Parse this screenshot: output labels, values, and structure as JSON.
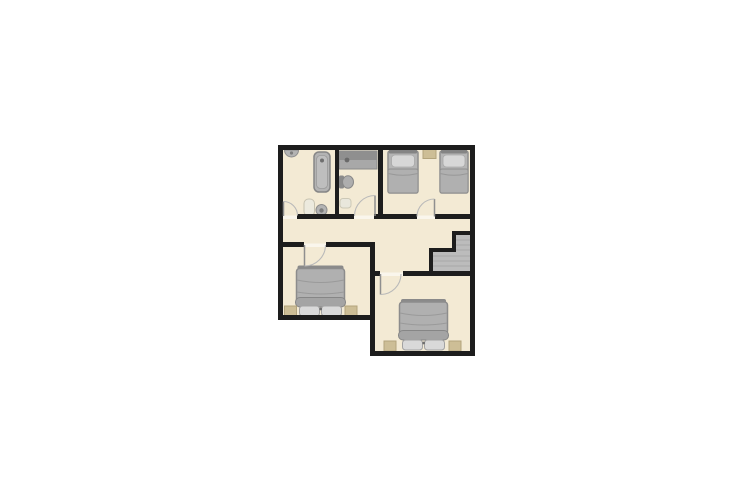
{
  "page": {
    "title": "floor-plan",
    "background": "#ffffff",
    "description": "2D floor plan of an upper storey: bathroom with bathtub, small WC with vanity counter, twin bedroom with two single beds, central hallway with staircase, and two double bedrooms below"
  },
  "palette": {
    "floor": "#f3ead4",
    "wall": "#1d1d1d",
    "furniture": "#b3b3b3",
    "furniture_dark": "#868686",
    "pillow": "#d9d9d9",
    "accent_tan": "#cdbe96",
    "stairs": "#bcbcbc",
    "white_fixture": "#eceade",
    "door_arc": "#b9b9b9"
  },
  "floorplan": {
    "canvas": {
      "width": 755,
      "height": 504
    },
    "rooms": [
      {
        "name": "bathroom-top-left",
        "fixtures": [
          "wall-basin",
          "bathtub",
          "toilet",
          "round-sink"
        ]
      },
      {
        "name": "wc-top-middle",
        "fixtures": [
          "vanity-counter",
          "wall-toilet",
          "bath-mat"
        ]
      },
      {
        "name": "bedroom-top-right",
        "fixtures": [
          "single-bed",
          "single-bed",
          "bedside-mat"
        ]
      },
      {
        "name": "hallway",
        "fixtures": [
          "staircase"
        ]
      },
      {
        "name": "bedroom-bottom-left",
        "fixtures": [
          "double-bed",
          "nightstand",
          "nightstand"
        ]
      },
      {
        "name": "bedroom-bottom-right",
        "fixtures": [
          "double-bed",
          "nightstand",
          "nightstand"
        ]
      }
    ],
    "door_count": 5,
    "shapes": [
      {
        "name": "floor-top-rooms",
        "type": "rect",
        "x": 280,
        "y": 147,
        "w": 193,
        "h": 127,
        "fill": "#f3ead4"
      },
      {
        "name": "floor-bedroom-left",
        "type": "rect",
        "x": 280,
        "y": 245,
        "w": 93,
        "h": 73,
        "fill": "#f3ead4"
      },
      {
        "name": "floor-bedroom-right",
        "type": "rect",
        "x": 373,
        "y": 274,
        "w": 100,
        "h": 80,
        "fill": "#f3ead4"
      },
      {
        "name": "staircase-fill",
        "type": "polygon",
        "points": "433,252 456,252 456,235 470,235 470,271 433,271",
        "fill": "#bcbcbc"
      },
      {
        "name": "stair-tread",
        "type": "line",
        "x1": 456,
        "y1": 240,
        "x2": 470,
        "y2": 240,
        "stroke": "#a9a9a9",
        "sw": 1
      },
      {
        "name": "stair-tread",
        "type": "line",
        "x1": 456,
        "y1": 245,
        "x2": 470,
        "y2": 245,
        "stroke": "#a9a9a9",
        "sw": 1
      },
      {
        "name": "stair-tread",
        "type": "line",
        "x1": 456,
        "y1": 250,
        "x2": 470,
        "y2": 250,
        "stroke": "#a9a9a9",
        "sw": 1
      },
      {
        "name": "stair-tread",
        "type": "line",
        "x1": 433,
        "y1": 256,
        "x2": 470,
        "y2": 256,
        "stroke": "#a9a9a9",
        "sw": 1
      },
      {
        "name": "stair-tread",
        "type": "line",
        "x1": 433,
        "y1": 261,
        "x2": 470,
        "y2": 261,
        "stroke": "#a9a9a9",
        "sw": 1
      },
      {
        "name": "stair-tread",
        "type": "line",
        "x1": 433,
        "y1": 266,
        "x2": 470,
        "y2": 266,
        "stroke": "#a9a9a9",
        "sw": 1
      },
      {
        "name": "wall-basin",
        "type": "path",
        "d": "M 284.5 150 A 7 7 0 0 0 298.5 150 Z",
        "fill": "#b3b3b3",
        "stroke": "#8d8d8d",
        "sw": 1
      },
      {
        "name": "wall-basin-faucet",
        "type": "circle",
        "cx": 291.5,
        "cy": 153,
        "r": 1.6,
        "fill": "#7d7d7d"
      },
      {
        "name": "bathtub",
        "type": "rect",
        "x": 314,
        "y": 152,
        "w": 16,
        "h": 40,
        "rx": 5,
        "fill": "#b3b3b3",
        "stroke": "#868686",
        "sw": 1.5
      },
      {
        "name": "bathtub-inner",
        "type": "rect",
        "x": 316.5,
        "y": 155.5,
        "w": 11,
        "h": 33,
        "rx": 4,
        "fill": "#bebebe",
        "stroke": "#9a9a9a",
        "sw": 0.8
      },
      {
        "name": "bathtub-drain",
        "type": "circle",
        "cx": 322,
        "cy": 160.5,
        "r": 2,
        "fill": "#6f6f6f"
      },
      {
        "name": "toilet",
        "type": "rect",
        "x": 304,
        "y": 199,
        "w": 10.5,
        "h": 17,
        "rx": 4.5,
        "fill": "#eceade",
        "stroke": "#c6c2b0",
        "sw": 1
      },
      {
        "name": "round-sink",
        "type": "circle",
        "cx": 321.5,
        "cy": 210,
        "r": 5.5,
        "fill": "#b3b3b3",
        "stroke": "#8d8d8d",
        "sw": 1
      },
      {
        "name": "round-sink-drain",
        "type": "circle",
        "cx": 321.5,
        "cy": 210.5,
        "r": 2.2,
        "fill": "#7d7d7d"
      },
      {
        "name": "vanity-counter",
        "type": "rect",
        "x": 339,
        "y": 151,
        "w": 38,
        "h": 18,
        "fill": "#a8a8a8",
        "stroke": "#8a8a8a",
        "sw": 1
      },
      {
        "name": "vanity-counter-back",
        "type": "rect",
        "x": 339,
        "y": 151,
        "w": 38,
        "h": 9,
        "fill": "#8f8f8f"
      },
      {
        "name": "vanity-faucet",
        "type": "circle",
        "cx": 347,
        "cy": 160,
        "r": 2.4,
        "fill": "#6a6a6a"
      },
      {
        "name": "wc-toilet-tank",
        "type": "rect",
        "x": 339,
        "y": 175.5,
        "w": 5,
        "h": 13,
        "rx": 1.5,
        "fill": "#8a8a8a"
      },
      {
        "name": "wc-toilet-bowl",
        "type": "ellipse",
        "cx": 348,
        "cy": 182,
        "rx": 5.5,
        "ry": 6.2,
        "fill": "#aeaeae",
        "stroke": "#888888",
        "sw": 1
      },
      {
        "name": "wc-mat",
        "type": "rect",
        "x": 340,
        "y": 198.5,
        "w": 11,
        "h": 9.5,
        "rx": 3,
        "fill": "#e9e7dc",
        "stroke": "#ccc8b6",
        "sw": 1
      },
      {
        "name": "bedside-mat",
        "type": "rect",
        "x": 423,
        "y": 149.5,
        "w": 13,
        "h": 9,
        "fill": "#cdbe96",
        "stroke": "#b3a47c",
        "sw": 1
      },
      {
        "name": "single-bed-left-base",
        "type": "rect",
        "x": 388,
        "y": 151,
        "w": 30,
        "h": 42,
        "rx": 2,
        "fill": "#b5b5b5",
        "stroke": "#8e8e8e",
        "sw": 1.5
      },
      {
        "name": "single-bed-left-headboard",
        "type": "rect",
        "x": 389,
        "y": 149.5,
        "w": 28,
        "h": 4,
        "rx": 1,
        "fill": "#848484"
      },
      {
        "name": "single-bed-left-pillow",
        "type": "rect",
        "x": 391.5,
        "y": 155,
        "w": 23,
        "h": 12,
        "rx": 3.5,
        "fill": "#d7d7d7",
        "stroke": "#a9a9a9",
        "sw": 0.8
      },
      {
        "name": "single-bed-left-duvet",
        "type": "rect",
        "x": 388,
        "y": 169,
        "w": 30,
        "h": 24,
        "rx": 2,
        "fill": "#b0b0b0",
        "stroke": "#8e8e8e",
        "sw": 1
      },
      {
        "name": "single-bed-left-fold",
        "type": "path",
        "d": "M 388 173.5 Q 403 177 418 173.5",
        "fill": "none",
        "stroke": "#989898",
        "sw": 1
      },
      {
        "name": "single-bed-right-base",
        "type": "rect",
        "x": 440,
        "y": 151,
        "w": 28,
        "h": 42,
        "rx": 2,
        "fill": "#b5b5b5",
        "stroke": "#8e8e8e",
        "sw": 1.5
      },
      {
        "name": "single-bed-right-headboard",
        "type": "rect",
        "x": 441,
        "y": 149.5,
        "w": 26,
        "h": 4,
        "rx": 1,
        "fill": "#848484"
      },
      {
        "name": "single-bed-right-pillow",
        "type": "rect",
        "x": 443,
        "y": 155,
        "w": 22,
        "h": 12,
        "rx": 3.5,
        "fill": "#d7d7d7",
        "stroke": "#a9a9a9",
        "sw": 0.8
      },
      {
        "name": "single-bed-right-duvet",
        "type": "rect",
        "x": 440,
        "y": 169,
        "w": 28,
        "h": 24,
        "rx": 2,
        "fill": "#b0b0b0",
        "stroke": "#8e8e8e",
        "sw": 1
      },
      {
        "name": "single-bed-right-fold",
        "type": "path",
        "d": "M 440 173.5 Q 454 177 468 173.5",
        "fill": "none",
        "stroke": "#989898",
        "sw": 1
      },
      {
        "name": "double-bed-left-footboard",
        "type": "rect",
        "x": 297.5,
        "y": 265.5,
        "w": 46,
        "h": 4.5,
        "rx": 2,
        "fill": "#8a8a8a"
      },
      {
        "name": "double-bed-left-duvet",
        "type": "rect",
        "x": 296.5,
        "y": 268.5,
        "w": 48,
        "h": 35,
        "rx": 3,
        "fill": "#b0b0b0",
        "stroke": "#8c8c8c",
        "sw": 1.5
      },
      {
        "name": "double-bed-left-fold-1",
        "type": "path",
        "d": "M 297 280 Q 320.5 285 344 280",
        "fill": "none",
        "stroke": "#9a9a9a",
        "sw": 1
      },
      {
        "name": "double-bed-left-fold-2",
        "type": "path",
        "d": "M 297 292 Q 320.5 296 344 292",
        "fill": "none",
        "stroke": "#9a9a9a",
        "sw": 1
      },
      {
        "name": "double-bed-left-roll",
        "type": "rect",
        "x": 295.5,
        "y": 297.5,
        "w": 50,
        "h": 9.5,
        "rx": 4.5,
        "fill": "#a4a4a4",
        "stroke": "#868686",
        "sw": 1
      },
      {
        "name": "double-bed-left-pillow-left",
        "type": "rect",
        "x": 299.5,
        "y": 306,
        "w": 20,
        "h": 10,
        "rx": 3,
        "fill": "#d9d9d9",
        "stroke": "#a2a2a2",
        "sw": 1
      },
      {
        "name": "double-bed-left-pillow-right",
        "type": "rect",
        "x": 321.5,
        "y": 306,
        "w": 20,
        "h": 10,
        "rx": 3,
        "fill": "#d9d9d9",
        "stroke": "#a2a2a2",
        "sw": 1
      },
      {
        "name": "double-bed-left-button",
        "type": "circle",
        "cx": 320.7,
        "cy": 309,
        "r": 1.4,
        "fill": "#6f6f6f"
      },
      {
        "name": "nightstand-left-1",
        "type": "rect",
        "x": 284.5,
        "y": 306,
        "w": 12,
        "h": 10,
        "fill": "#cdbe96",
        "stroke": "#b3a47c",
        "sw": 1
      },
      {
        "name": "nightstand-left-2",
        "type": "rect",
        "x": 345,
        "y": 306,
        "w": 12,
        "h": 10,
        "fill": "#cdbe96",
        "stroke": "#b3a47c",
        "sw": 1
      },
      {
        "name": "double-bed-right-footboard",
        "type": "rect",
        "x": 401,
        "y": 299,
        "w": 45,
        "h": 4.5,
        "rx": 2,
        "fill": "#8a8a8a"
      },
      {
        "name": "double-bed-right-duvet",
        "type": "rect",
        "x": 399.5,
        "y": 302,
        "w": 48,
        "h": 32,
        "rx": 3,
        "fill": "#b0b0b0",
        "stroke": "#8c8c8c",
        "sw": 1.5
      },
      {
        "name": "double-bed-right-fold-1",
        "type": "path",
        "d": "M 400 313 Q 423.5 318 447 313",
        "fill": "none",
        "stroke": "#9a9a9a",
        "sw": 1
      },
      {
        "name": "double-bed-right-fold-2",
        "type": "path",
        "d": "M 400 323 Q 423.5 327 447 323",
        "fill": "none",
        "stroke": "#9a9a9a",
        "sw": 1
      },
      {
        "name": "double-bed-right-roll",
        "type": "rect",
        "x": 398.5,
        "y": 330.5,
        "w": 50,
        "h": 9.5,
        "rx": 4.5,
        "fill": "#a4a4a4",
        "stroke": "#868686",
        "sw": 1
      },
      {
        "name": "double-bed-right-pillow-left",
        "type": "rect",
        "x": 402.5,
        "y": 340,
        "w": 20,
        "h": 10,
        "rx": 3,
        "fill": "#d9d9d9",
        "stroke": "#a2a2a2",
        "sw": 1
      },
      {
        "name": "double-bed-right-pillow-right",
        "type": "rect",
        "x": 424.5,
        "y": 340,
        "w": 20,
        "h": 10,
        "rx": 3,
        "fill": "#d9d9d9",
        "stroke": "#a2a2a2",
        "sw": 1
      },
      {
        "name": "double-bed-right-button",
        "type": "circle",
        "cx": 423.7,
        "cy": 343,
        "r": 1.4,
        "fill": "#6f6f6f"
      },
      {
        "name": "nightstand-right-1",
        "type": "rect",
        "x": 384,
        "y": 341,
        "w": 12,
        "h": 10,
        "fill": "#cdbe96",
        "stroke": "#b3a47c",
        "sw": 1
      },
      {
        "name": "nightstand-right-2",
        "type": "rect",
        "x": 449,
        "y": 341,
        "w": 12,
        "h": 10,
        "fill": "#cdbe96",
        "stroke": "#b3a47c",
        "sw": 1
      },
      {
        "name": "wall-outer-top",
        "type": "rect",
        "x": 278,
        "y": 145,
        "w": 197,
        "h": 5,
        "fill": "#1d1d1d"
      },
      {
        "name": "wall-outer-left",
        "type": "rect",
        "x": 278,
        "y": 145,
        "w": 5,
        "h": 175,
        "fill": "#1d1d1d"
      },
      {
        "name": "wall-outer-right",
        "type": "rect",
        "x": 470,
        "y": 145,
        "w": 5,
        "h": 211,
        "fill": "#1d1d1d"
      },
      {
        "name": "wall-divider-bath-wc",
        "type": "rect",
        "x": 335,
        "y": 148,
        "w": 4,
        "h": 69,
        "fill": "#1d1d1d"
      },
      {
        "name": "wall-divider-wc-bedroom",
        "type": "rect",
        "x": 378,
        "y": 148,
        "w": 5,
        "h": 69,
        "fill": "#1d1d1d"
      },
      {
        "name": "wall-hall-top-1",
        "type": "rect",
        "x": 297,
        "y": 214,
        "w": 57,
        "h": 5,
        "fill": "#1d1d1d"
      },
      {
        "name": "wall-hall-top-2",
        "type": "rect",
        "x": 374,
        "y": 214,
        "w": 43,
        "h": 5,
        "fill": "#1d1d1d"
      },
      {
        "name": "wall-hall-top-3",
        "type": "rect",
        "x": 435,
        "y": 214,
        "w": 35,
        "h": 5,
        "fill": "#1d1d1d"
      },
      {
        "name": "wall-bedroom-left-top-1",
        "type": "rect",
        "x": 278,
        "y": 242,
        "w": 26,
        "h": 5,
        "fill": "#1d1d1d"
      },
      {
        "name": "wall-bedroom-left-top-2",
        "type": "rect",
        "x": 326,
        "y": 242,
        "w": 49,
        "h": 5,
        "fill": "#1d1d1d"
      },
      {
        "name": "wall-center-vertical",
        "type": "rect",
        "x": 370,
        "y": 242,
        "w": 5,
        "h": 114,
        "fill": "#1d1d1d"
      },
      {
        "name": "wall-bedroom-right-top-1",
        "type": "rect",
        "x": 373,
        "y": 271,
        "w": 7,
        "h": 5,
        "fill": "#1d1d1d"
      },
      {
        "name": "wall-bedroom-right-top-2",
        "type": "rect",
        "x": 403,
        "y": 271,
        "w": 72,
        "h": 5,
        "fill": "#1d1d1d"
      },
      {
        "name": "wall-bedroom-left-bottom",
        "type": "rect",
        "x": 278,
        "y": 315,
        "w": 97,
        "h": 5,
        "fill": "#1d1d1d"
      },
      {
        "name": "wall-bedroom-right-bottom",
        "type": "rect",
        "x": 370,
        "y": 351,
        "w": 105,
        "h": 5,
        "fill": "#1d1d1d"
      },
      {
        "name": "wall-stair-step-top",
        "type": "rect",
        "x": 452,
        "y": 231,
        "w": 18,
        "h": 4,
        "fill": "#1d1d1d"
      },
      {
        "name": "wall-stair-step-v1",
        "type": "rect",
        "x": 452,
        "y": 231,
        "w": 4,
        "h": 19,
        "fill": "#1d1d1d"
      },
      {
        "name": "wall-stair-step-mid",
        "type": "rect",
        "x": 429,
        "y": 248,
        "w": 27,
        "h": 4,
        "fill": "#1d1d1d"
      },
      {
        "name": "wall-stair-step-v2",
        "type": "rect",
        "x": 429,
        "y": 248,
        "w": 4,
        "h": 25,
        "fill": "#1d1d1d"
      },
      {
        "name": "threshold-bathroom",
        "type": "rect",
        "x": 283,
        "y": 215.5,
        "w": 14,
        "h": 3.5,
        "fill": "#ffffff",
        "opacity": 0.55
      },
      {
        "name": "threshold-wc",
        "type": "rect",
        "x": 354,
        "y": 215.5,
        "w": 20,
        "h": 3.5,
        "fill": "#ffffff",
        "opacity": 0.55
      },
      {
        "name": "threshold-twin-bedroom",
        "type": "rect",
        "x": 417,
        "y": 215.5,
        "w": 18,
        "h": 3.5,
        "fill": "#ffffff",
        "opacity": 0.55
      },
      {
        "name": "threshold-bedroom-left",
        "type": "rect",
        "x": 304,
        "y": 243.5,
        "w": 22,
        "h": 3.5,
        "fill": "#ffffff",
        "opacity": 0.55
      },
      {
        "name": "threshold-bedroom-right",
        "type": "rect",
        "x": 380,
        "y": 272.5,
        "w": 23,
        "h": 3.5,
        "fill": "#ffffff",
        "opacity": 0.55
      },
      {
        "name": "door-bathroom-leaf",
        "type": "line",
        "x1": 283.5,
        "y1": 216,
        "x2": 283.5,
        "y2": 201.5,
        "stroke": "#8f8f8f",
        "sw": 1.5
      },
      {
        "name": "door-bathroom-arc",
        "type": "path",
        "d": "M 283.5 201.5 A 14 14 0 0 1 297.5 215.5",
        "fill": "none",
        "stroke": "#b9b9b9",
        "sw": 1.1
      },
      {
        "name": "door-wc-leaf",
        "type": "line",
        "x1": 375,
        "y1": 216,
        "x2": 375,
        "y2": 195.5,
        "stroke": "#8f8f8f",
        "sw": 1.5
      },
      {
        "name": "door-wc-arc",
        "type": "path",
        "d": "M 375 195.5 A 20.5 20.5 0 0 0 354.5 216",
        "fill": "none",
        "stroke": "#b9b9b9",
        "sw": 1.1
      },
      {
        "name": "door-twin-bedroom-leaf",
        "type": "line",
        "x1": 434.5,
        "y1": 216.5,
        "x2": 434.5,
        "y2": 199,
        "stroke": "#8f8f8f",
        "sw": 1.5
      },
      {
        "name": "door-twin-bedroom-arc",
        "type": "path",
        "d": "M 434.5 199 A 17.5 17.5 0 0 0 417 216.5",
        "fill": "none",
        "stroke": "#b9b9b9",
        "sw": 1.1
      },
      {
        "name": "door-bedroom-left-leaf",
        "type": "line",
        "x1": 304.5,
        "y1": 245,
        "x2": 304.5,
        "y2": 266,
        "stroke": "#8f8f8f",
        "sw": 1.5
      },
      {
        "name": "door-bedroom-left-arc",
        "type": "path",
        "d": "M 304.5 266 A 21 21 0 0 0 325.5 245",
        "fill": "none",
        "stroke": "#b9b9b9",
        "sw": 1.1
      },
      {
        "name": "door-bedroom-right-leaf",
        "type": "line",
        "x1": 380.5,
        "y1": 274,
        "x2": 380.5,
        "y2": 294.5,
        "stroke": "#8f8f8f",
        "sw": 1.5
      },
      {
        "name": "door-bedroom-right-arc",
        "type": "path",
        "d": "M 380.5 294.5 A 20.5 20.5 0 0 0 401 274",
        "fill": "none",
        "stroke": "#b9b9b9",
        "sw": 1.1
      }
    ]
  }
}
